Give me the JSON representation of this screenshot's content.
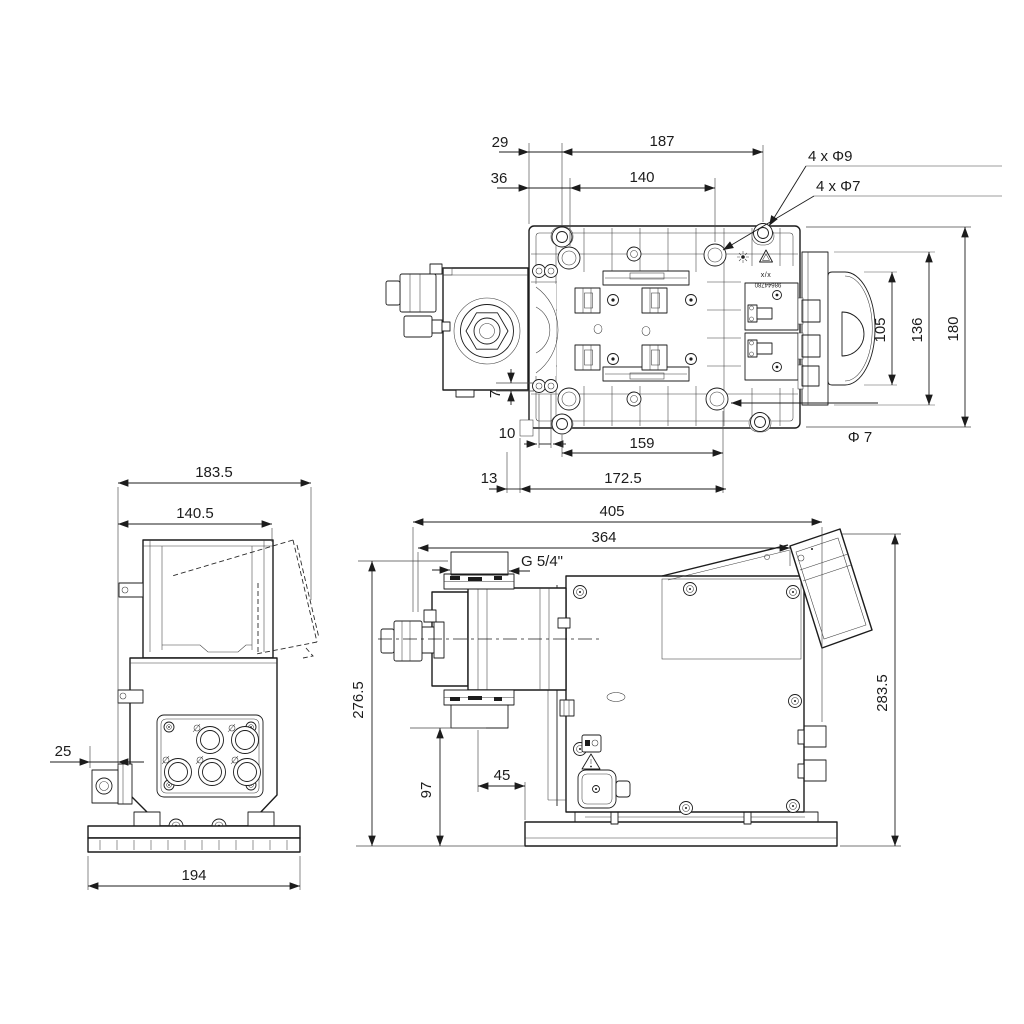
{
  "top": {
    "d29": "29",
    "d187": "187",
    "d36": "36",
    "d140": "140",
    "leader_phi9": "4 x Φ9",
    "leader_phi7": "4 x Φ7",
    "d105": "105",
    "d136": "136",
    "d180": "180",
    "d7": "7",
    "d10": "10",
    "d159": "159",
    "dphi7": "Φ 7",
    "d13": "13",
    "d1725": "172.5",
    "mark1": "x/x",
    "mark2": "98644780"
  },
  "front": {
    "d1835": "183.5",
    "d1405": "140.5",
    "d25": "25",
    "d194": "194"
  },
  "side": {
    "d405": "405",
    "d364": "364",
    "thread": "G 5/4\"",
    "d2765": "276.5",
    "d97": "97",
    "d45": "45",
    "d2835": "283.5"
  },
  "colors": {
    "line": "#1c1c1c",
    "ext_gray": "#8f8f8f",
    "background": "#ffffff"
  }
}
